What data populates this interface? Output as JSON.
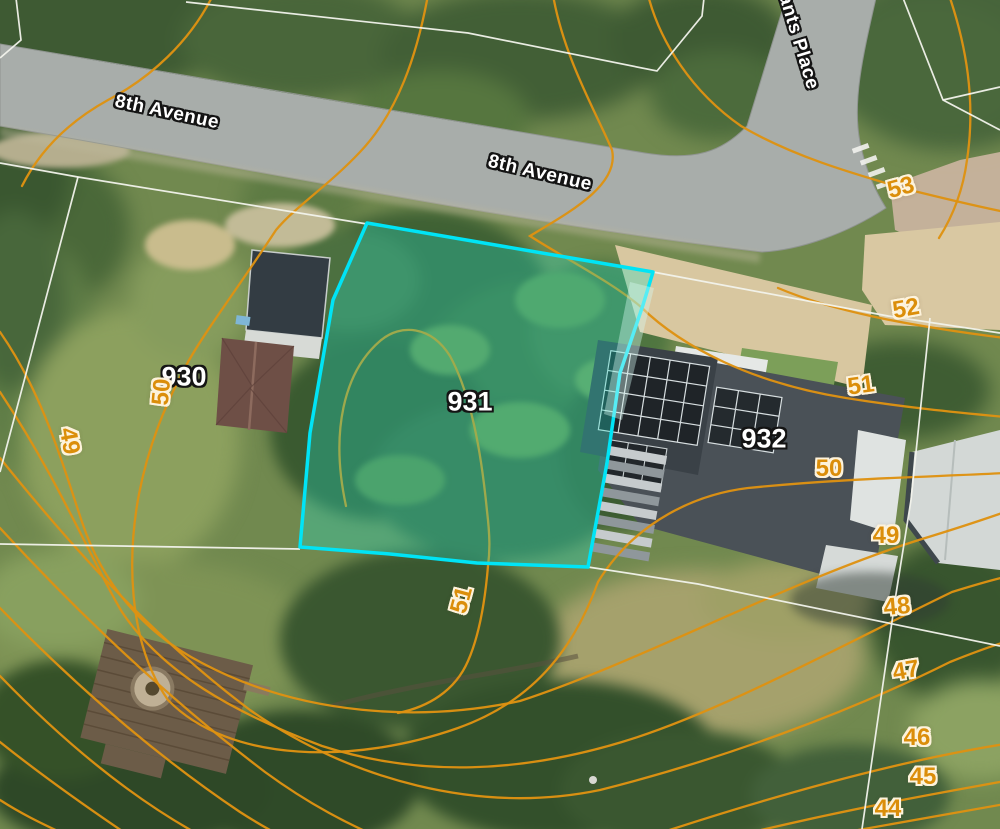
{
  "map": {
    "type": "aerial-parcel-map",
    "streets": {
      "avenue_west": "8th Avenue",
      "avenue_center": "8th Avenue",
      "place_northeast": "rants Place"
    },
    "lots": {
      "l930": "930",
      "l931": "931",
      "l932": "932"
    },
    "highlighted_lot": "931",
    "contour_elevations": {
      "c53": "53",
      "c52": "52",
      "c51_right": "51",
      "c51_south": "51",
      "c50_right": "50",
      "c50_left": "50",
      "c49_right": "49",
      "c49_left": "49",
      "c48": "48",
      "c47": "47",
      "c46": "46",
      "c45": "45",
      "c44": "44"
    },
    "colors": {
      "contourLine": "#DE9212",
      "contourLabel": "#DB8E0A",
      "contourHalo": "#FDF3DC",
      "boundaryLine": "#F2F3EC",
      "highlightBorder": "#00E4F6",
      "highlightFill": "rgba(35,225,200,0.32)",
      "roadSurface": "#A8ADAA",
      "labelText": "#FFFFFF",
      "labelOutline": "#141414"
    }
  }
}
